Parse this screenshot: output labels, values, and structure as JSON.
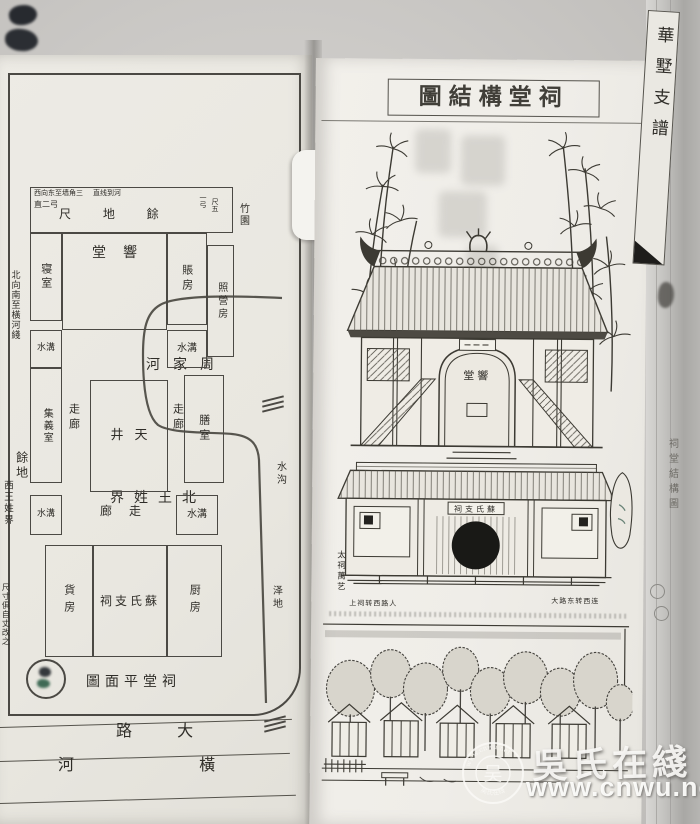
{
  "colors": {
    "ink": "#3c3a33",
    "paper_left": "#eae8e1",
    "paper_right": "#f1efea",
    "photo_background": "#cbc9c6",
    "watermark_white": "#f7f6f3"
  },
  "left_page": {
    "river_top": "河家周",
    "boundary_north": "界姓王北",
    "band": {
      "small1": "西向东至墙角三",
      "small2": "直线到河",
      "small3": "直二弓",
      "center": "尺 地 餘",
      "right1": "一弓",
      "right2": "尺五"
    },
    "bamboo_garden": "竹園",
    "rooms": {
      "bedroom": "寝室",
      "hall": "堂響",
      "account": "賬房",
      "duty": "照營房",
      "gutter": "水溝",
      "meeting": "集義室",
      "corridor": "走廊",
      "courtyard": "井天",
      "dining": "膳室",
      "corridor_bottom": "廊走",
      "goods": "貨房",
      "shrine": "祠支氏蘇",
      "kitchen": "厨房"
    },
    "caption": "圖面平堂祠",
    "margin_left": {
      "a": "北向南至橫河綫",
      "b": "餘地",
      "c": "西王姓界",
      "d": "尺寸俱自丈改之"
    },
    "margin_right": {
      "a": "水沟",
      "b": "泽地"
    },
    "road": "路 大",
    "river_bottom": "河 橫"
  },
  "right_page": {
    "title": "圖結構堂祠",
    "arch_plaque": "堂響",
    "gate_plaque": "祠支氏蘇",
    "side_note": "太祠萬艺",
    "caption_left": "上祠转西路人",
    "caption_right": "大路东转西连"
  },
  "spine": {
    "title": "華墅支譜",
    "inner_caption": "祠堂結構圖"
  },
  "watermark": {
    "brand": "吳氏在綫",
    "url": "www.cnwu.net",
    "seal_top": "www.cnwu.net",
    "seal_bottom": "吴氏在线",
    "seal_center": "吴"
  }
}
